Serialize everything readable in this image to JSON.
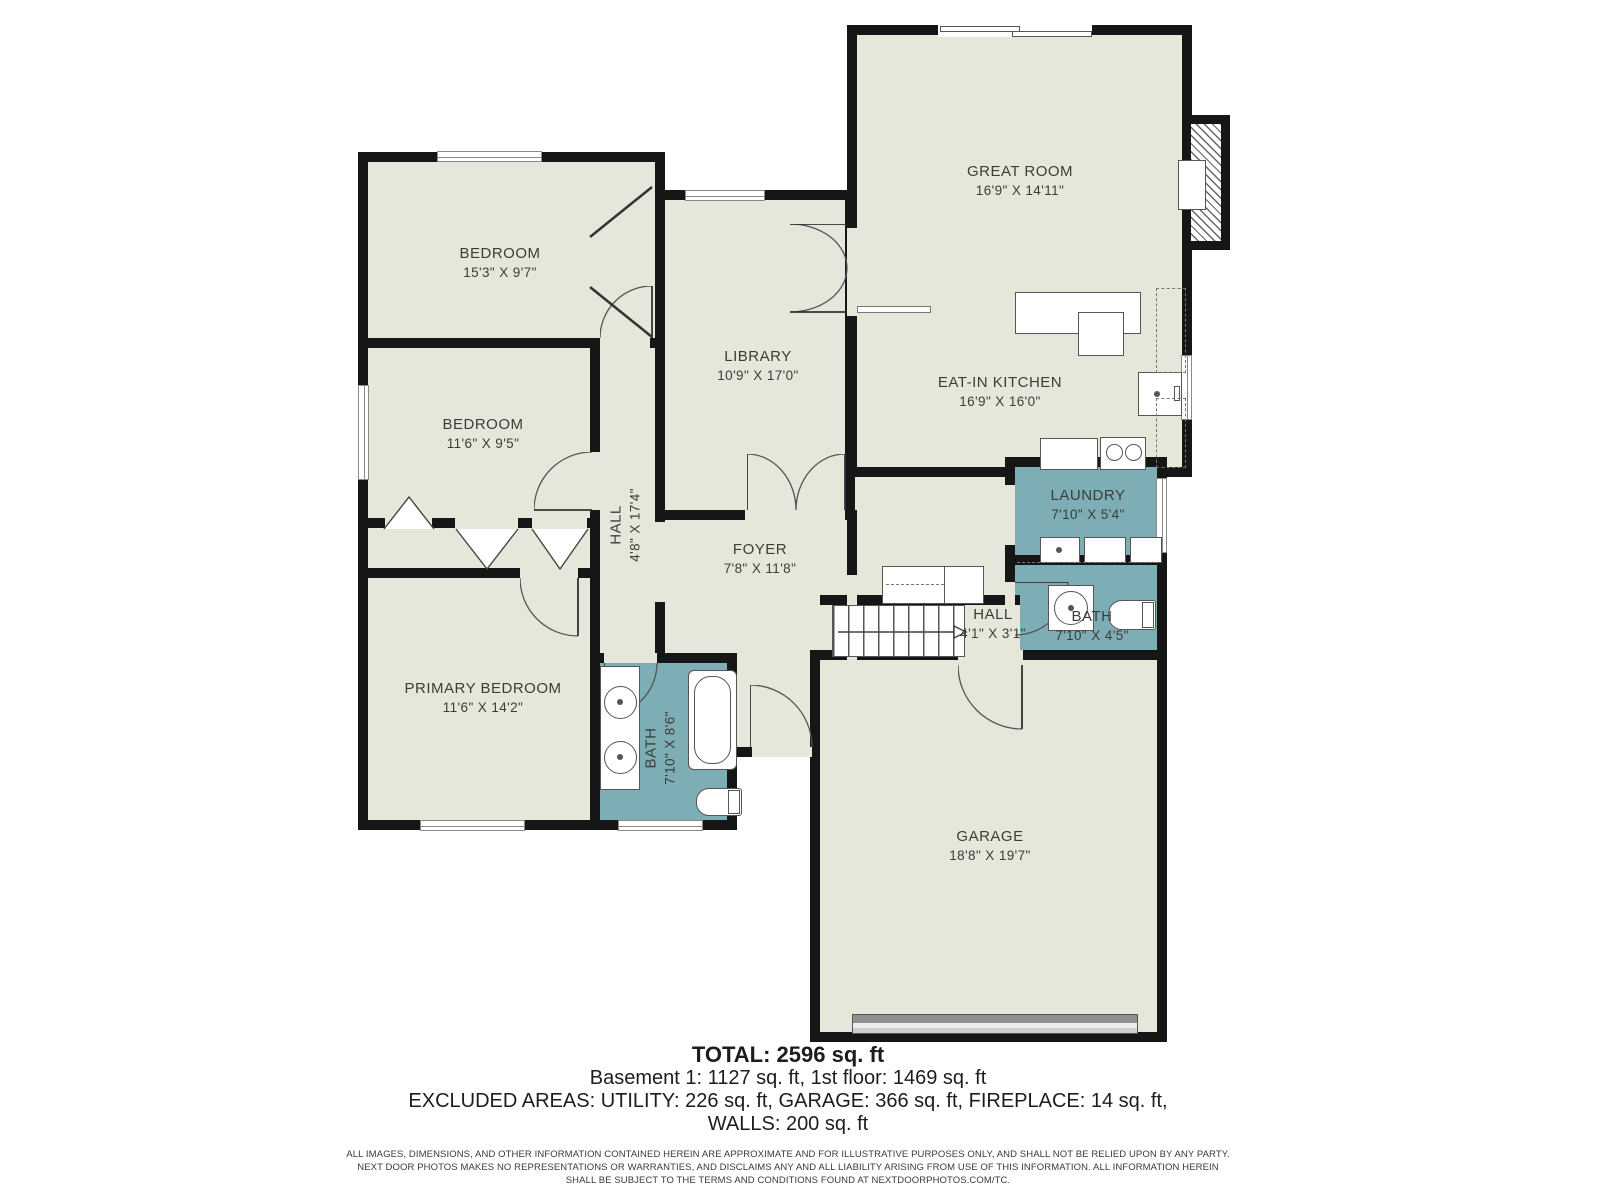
{
  "plan": {
    "rooms": [
      {
        "id": "great-room",
        "name": "GREAT ROOM",
        "dims": "16'9\" X 14'11\""
      },
      {
        "id": "eat-in-kitchen",
        "name": "EAT-IN KITCHEN",
        "dims": "16'9\" X 16'0\""
      },
      {
        "id": "bedroom-1",
        "name": "BEDROOM",
        "dims": "15'3\" X 9'7\""
      },
      {
        "id": "bedroom-2",
        "name": "BEDROOM",
        "dims": "11'6\" X 9'5\""
      },
      {
        "id": "library",
        "name": "LIBRARY",
        "dims": "10'9\" X 17'0\""
      },
      {
        "id": "hall-upper",
        "name": "HALL",
        "dims": "4'8\" X 17'4\""
      },
      {
        "id": "foyer",
        "name": "FOYER",
        "dims": "7'8\" X 11'8\""
      },
      {
        "id": "laundry",
        "name": "LAUNDRY",
        "dims": "7'10\" X 5'4\""
      },
      {
        "id": "bath-right",
        "name": "BATH",
        "dims": "7'10\" X 4'5\""
      },
      {
        "id": "hall-stairs",
        "name": "HALL",
        "dims": "4'1\" X 3'1\""
      },
      {
        "id": "bath-primary",
        "name": "BATH",
        "dims": "7'10\" X 8'6\""
      },
      {
        "id": "primary-bedroom",
        "name": "PRIMARY BEDROOM",
        "dims": "11'6\" X 14'2\""
      },
      {
        "id": "garage",
        "name": "GARAGE",
        "dims": "18'8\" X 19'7\""
      }
    ],
    "colors": {
      "floor": "#e7e6db",
      "wet_room": "#7dadb5",
      "wall": "#161616",
      "garage_door": "#8f8f8f"
    }
  },
  "summary": {
    "total": "TOTAL: 2596 sq. ft",
    "line2": "Basement 1: 1127 sq. ft, 1st floor: 1469 sq. ft",
    "line3": "EXCLUDED AREAS: UTILITY: 226 sq. ft, GARAGE: 366 sq. ft, FIREPLACE: 14 sq. ft,",
    "line4": "WALLS: 200 sq. ft"
  },
  "disclaimer": {
    "line1": "ALL IMAGES, DIMENSIONS, AND OTHER INFORMATION CONTAINED HEREIN ARE APPROXIMATE AND FOR ILLUSTRATIVE PURPOSES ONLY, AND SHALL NOT BE RELIED UPON BY ANY PARTY.",
    "line2": "NEXT DOOR PHOTOS MAKES NO REPRESENTATIONS OR WARRANTIES, AND DISCLAIMS ANY AND ALL LIABILITY ARISING FROM USE OF THIS INFORMATION. ALL INFORMATION HEREIN",
    "line3": "SHALL BE SUBJECT TO THE TERMS AND CONDITIONS FOUND AT NEXTDOORPHOTOS.COM/TC."
  }
}
